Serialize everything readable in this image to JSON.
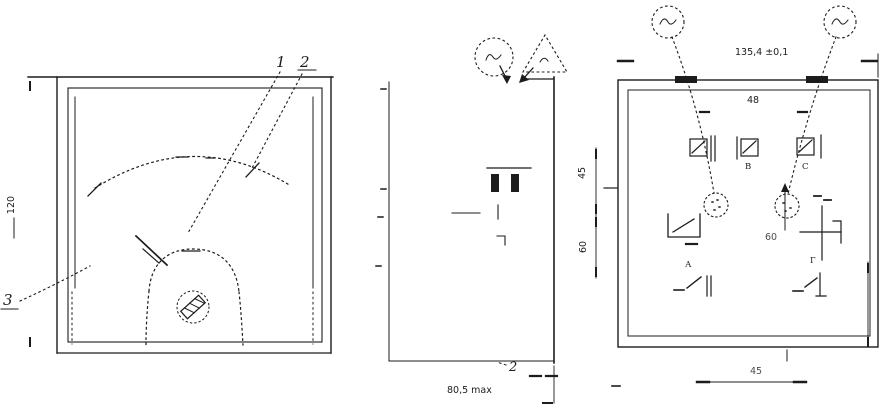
{
  "title": "panel-meter-outline-drawing",
  "colors": {
    "ink": "#1c1c1c",
    "paper": "#ffffff"
  },
  "front_view": {
    "callouts": {
      "pointer": "1",
      "scale": "2",
      "bezel": "3"
    },
    "height_dim": "120"
  },
  "side_view": {
    "callout": "2",
    "depth_dim": "80,5 max"
  },
  "rear_view": {
    "width_dim": "135,4 ±0,1",
    "top_dim": "48",
    "left_dim_upper": "45",
    "left_dim_lower": "60",
    "center_dim": "60",
    "bottom_dim": "45",
    "terminals": {
      "upper_mid": "В",
      "upper_right": "С",
      "lower_left": "А",
      "lower_right": "Г"
    }
  }
}
